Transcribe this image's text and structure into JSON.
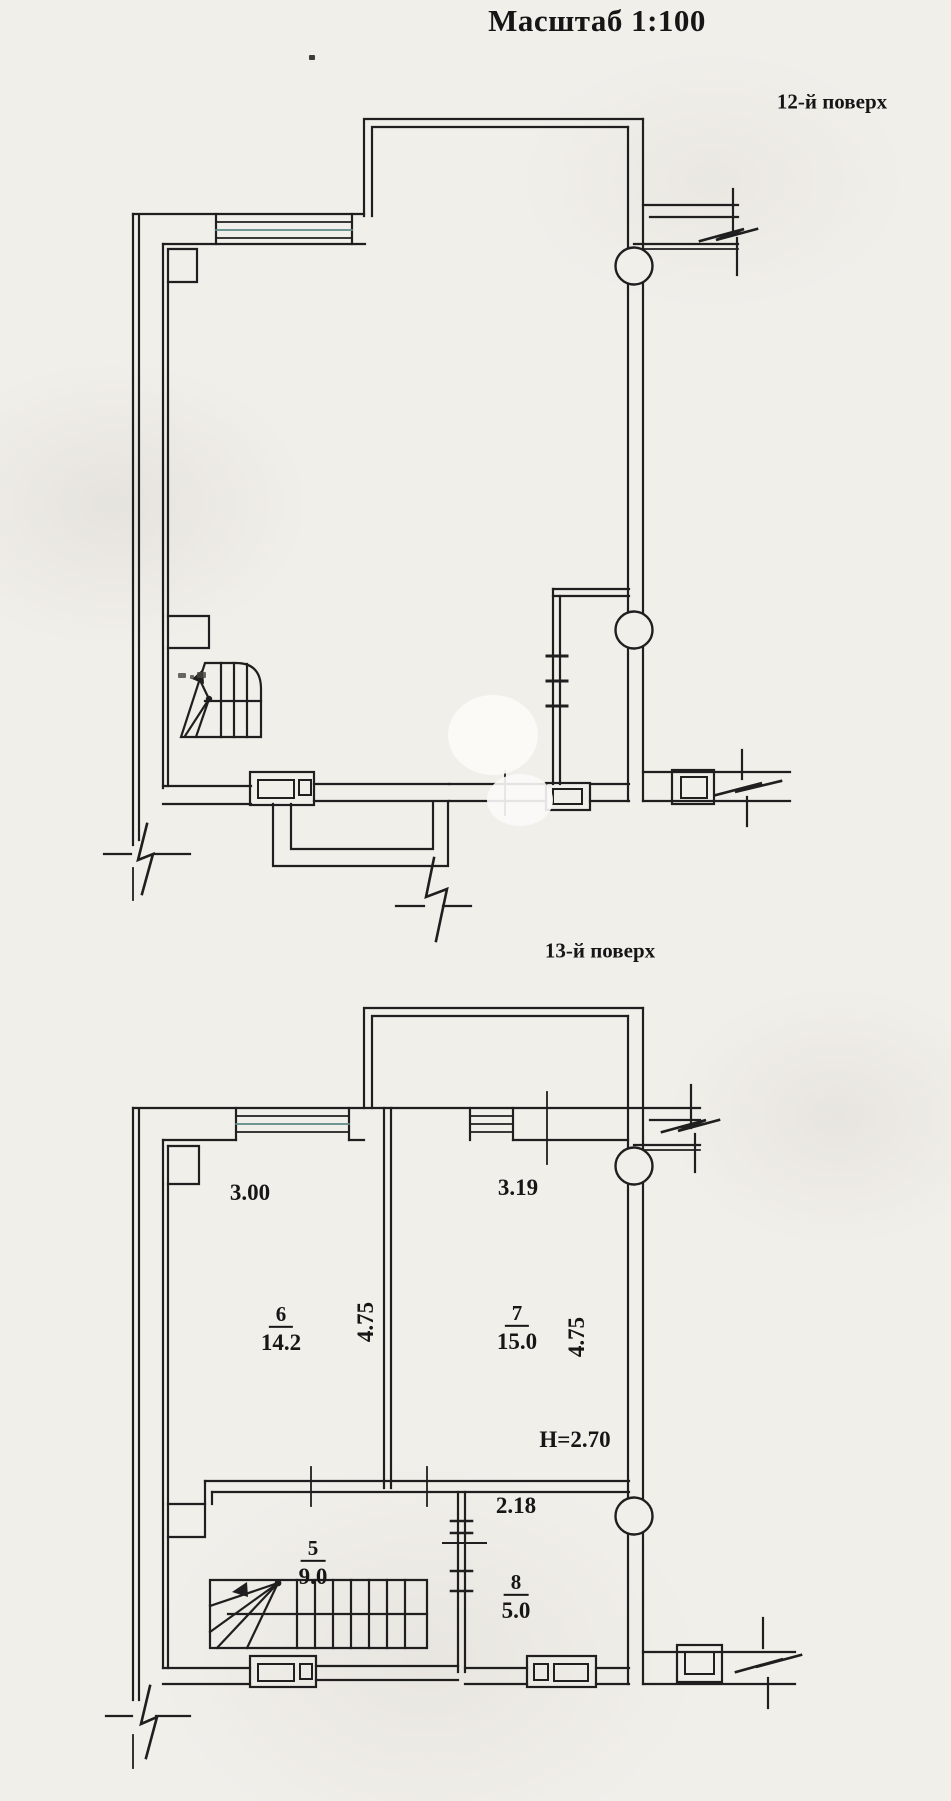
{
  "title": "Масштаб 1:100",
  "floors": [
    {
      "label": "12-й поверх"
    },
    {
      "label": "13-й поверх",
      "dimensions": {
        "room6_width": "3.00",
        "room7_width": "3.19",
        "room6_depth": "4.75",
        "room7_depth": "4.75",
        "room8_width": "2.18",
        "ceiling_height": "H=2.70"
      },
      "rooms": [
        {
          "number": "6",
          "area": "14.2"
        },
        {
          "number": "7",
          "area": "15.0"
        },
        {
          "number": "5",
          "area": "9.0"
        },
        {
          "number": "8",
          "area": "5.0"
        }
      ]
    }
  ],
  "colors": {
    "paper": "#f1efea",
    "ink": "#1f1f1f",
    "window_tint": "#5d8a87"
  }
}
